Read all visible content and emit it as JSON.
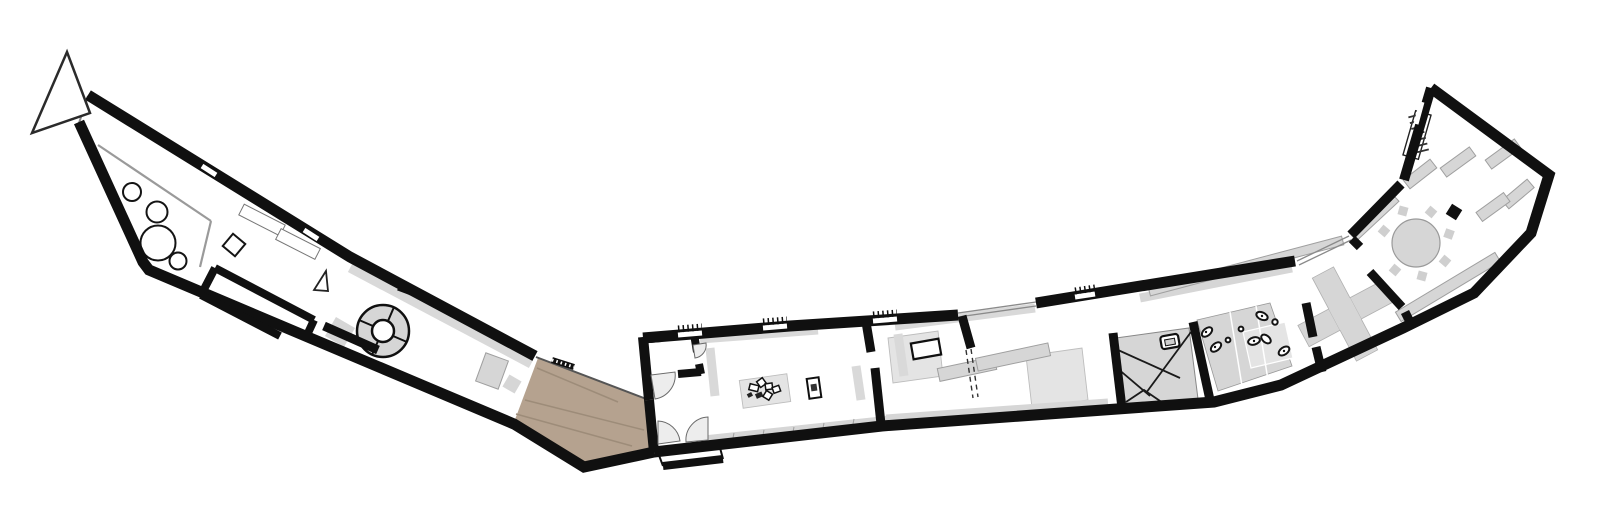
{
  "meta": {
    "kind": "architectural-floor-plan",
    "building_shape": "elongated boomerang / V-shaped single storey plan",
    "orientation_marker": "north-arrow-triangle-top-left"
  },
  "palette": {
    "background": "#ffffff",
    "wall": "#101010",
    "glass": "#8a8a8a",
    "partition": "#9a9a9a",
    "furniture": "#d6d6d6",
    "furniture_edge": "#9f9f9f",
    "counter": "#d9d9d9",
    "mat": "#e4e4e4",
    "mat_edge": "#bdbdbd",
    "ramp": "#b5a28f",
    "ramp_line": "#9d8c79",
    "door": "#ededed",
    "door_edge": "#6b6b6b",
    "fixture": "#141414",
    "arrow_edge": "#2b2b2b"
  },
  "legend": [
    {
      "name": "north-arrow",
      "kind": "orientation symbol"
    },
    {
      "name": "entrance-ramp",
      "kind": "tan sloped entry surface at the V-bottom"
    },
    {
      "name": "main-entrance-double-door",
      "kind": "two quarter-circle door swings"
    },
    {
      "name": "round-stair-element",
      "kind": "circular segmented element in left wing"
    },
    {
      "name": "cafe-tables",
      "kind": "four circles in left end room"
    },
    {
      "name": "exhibit-mat-with-models",
      "kind": "gray mat with scattered small rectangles"
    },
    {
      "name": "interior-stair",
      "kind": "gray flight with converging lines"
    },
    {
      "name": "wc-fixtures",
      "kind": "oval sanitary symbols on gray block"
    },
    {
      "name": "cross-sculpture",
      "kind": "large gray X object in hall"
    },
    {
      "name": "round-table-with-chairs",
      "kind": "circle with diamond chairs, right wing"
    },
    {
      "name": "display-slabs",
      "kind": "rotated gray rectangles, right wing"
    },
    {
      "name": "glazed-corridor",
      "kind": "thin double line wall, upper right"
    }
  ]
}
